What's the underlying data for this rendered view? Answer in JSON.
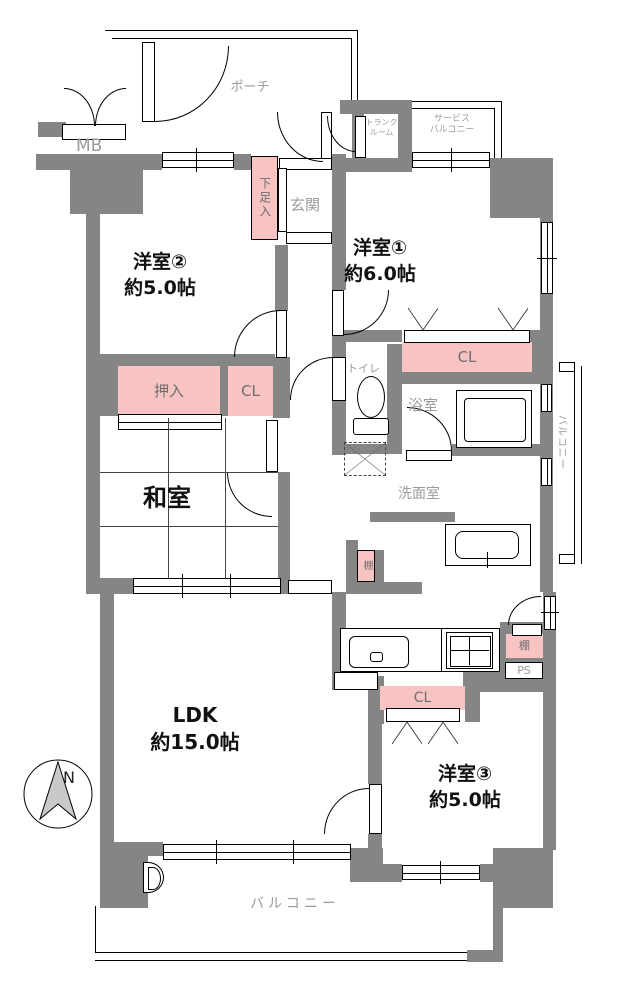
{
  "floor_plan": {
    "colors": {
      "wall": "#858585",
      "closet": "#F8C3C3",
      "label": "#9C9C9C",
      "label_dark": "#6E6E6E",
      "room_text": "#111111",
      "north_fill": "#C9C9C9"
    },
    "rooms": {
      "porch": {
        "label": "ポーチ"
      },
      "mb": {
        "label": "MB"
      },
      "trunk": {
        "line1": "トランク",
        "line2": "ルーム"
      },
      "service_balcony": {
        "line1": "サービス",
        "line2": "バルコニー"
      },
      "entrance": {
        "label": "玄関"
      },
      "western2": {
        "name": "洋室②",
        "size": "約5.0帖"
      },
      "western1": {
        "name": "洋室①",
        "size": "約6.0帖"
      },
      "japanese": {
        "name": "和室"
      },
      "toilet": {
        "label": "トイレ"
      },
      "bathroom": {
        "label": "浴室"
      },
      "washroom": {
        "label": "洗面室"
      },
      "ldk": {
        "name": "LDK",
        "size": "約15.0帖"
      },
      "western3": {
        "name": "洋室③",
        "size": "約5.0帖"
      },
      "balcony": {
        "label": "バルコニー"
      },
      "side_balcony": {
        "label": "バルコニー"
      }
    },
    "storage": {
      "shoe_cabinet": "下足入",
      "oshiire": "押入",
      "closet": "CL",
      "shelf": "棚",
      "pipe_space": "PS"
    },
    "compass": {
      "north": "N"
    }
  }
}
